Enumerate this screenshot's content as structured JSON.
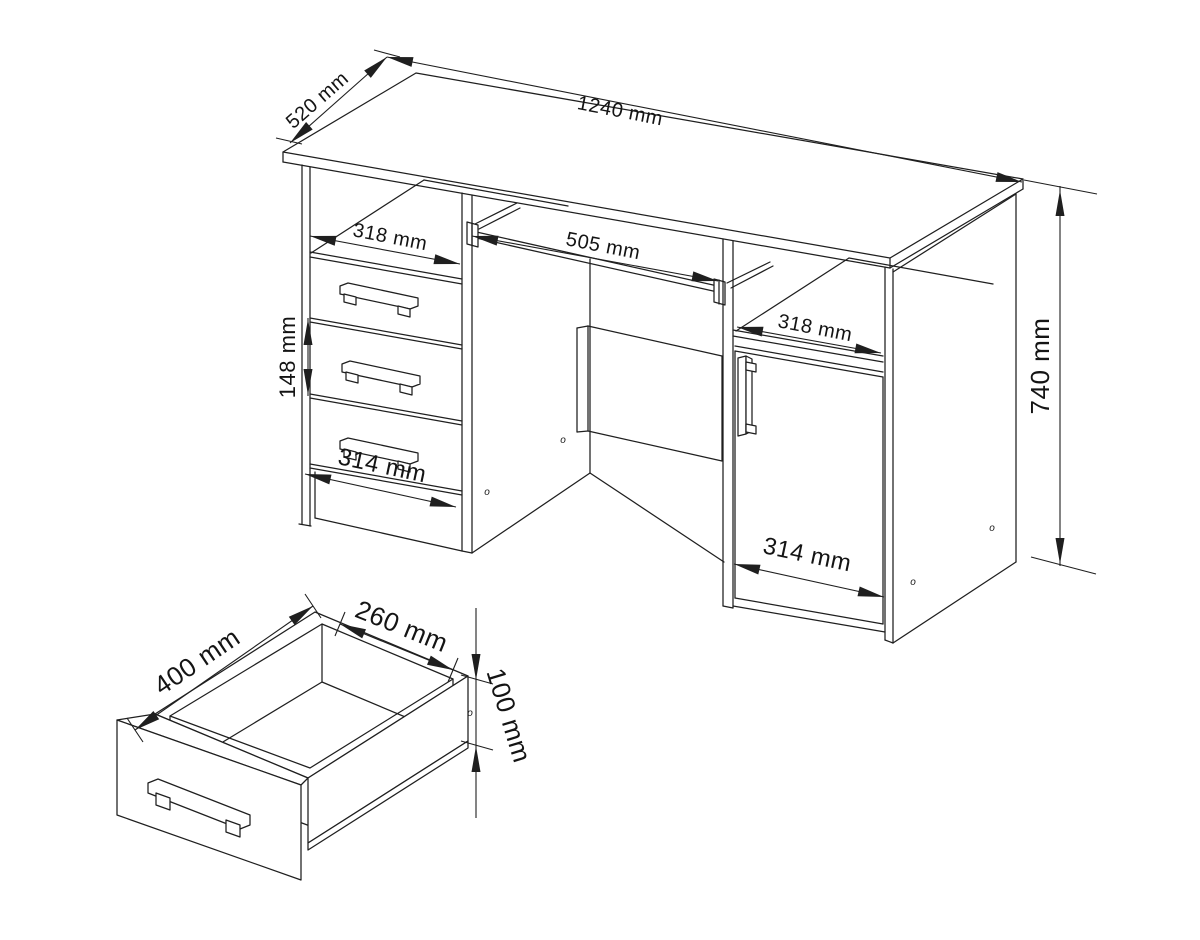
{
  "colors": {
    "line": "#1f1f1f",
    "background": "#ffffff",
    "text": "#141414"
  },
  "hole_marker": "o",
  "desk": {
    "dimensions": {
      "depth": {
        "label": "520 mm"
      },
      "width": {
        "label": "1240 mm"
      },
      "left_opening": {
        "label": "318 mm"
      },
      "tray": {
        "label": "505 mm"
      },
      "right_opening": {
        "label": "318 mm"
      },
      "drawer_pitch": {
        "label": "148 mm"
      },
      "left_front": {
        "label": "314 mm"
      },
      "right_front": {
        "label": "314 mm"
      },
      "height": {
        "label": "740 mm"
      }
    }
  },
  "drawer": {
    "dimensions": {
      "depth": {
        "label": "400 mm"
      },
      "width": {
        "label": "260 mm"
      },
      "height": {
        "label": "100 mm"
      }
    }
  }
}
